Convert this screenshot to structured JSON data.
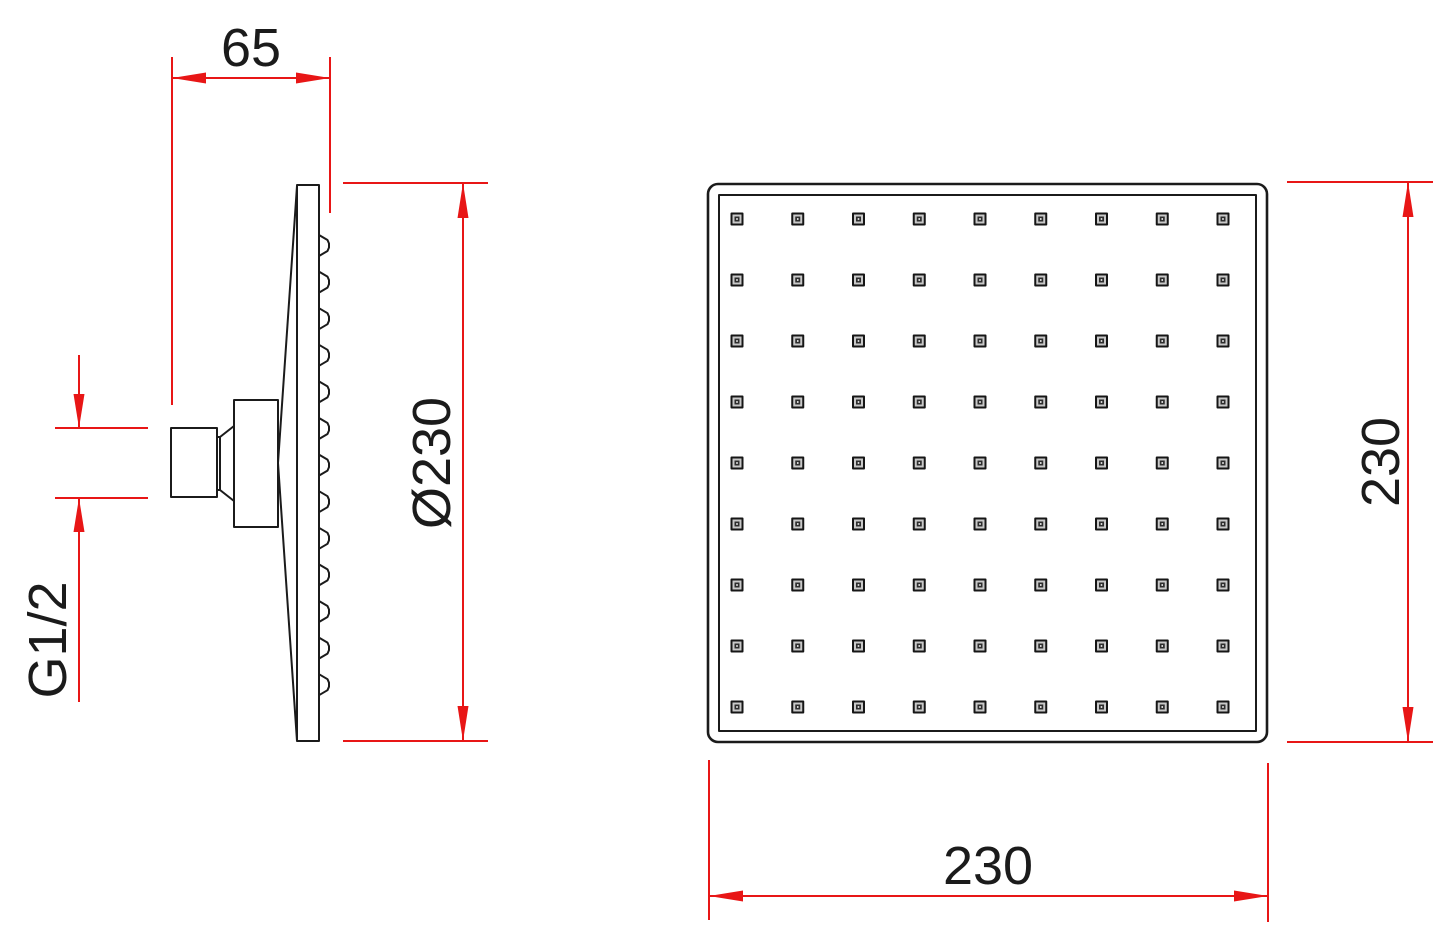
{
  "page": {
    "background": "#ffffff",
    "description": "Technical dimension drawing of a square overhead shower head, side profile view and front face view"
  },
  "colors": {
    "line": "#1b1b1b",
    "dimension": "#e81616"
  },
  "side_view": {
    "name": "shower head side profile",
    "depth_dim": {
      "value": "65"
    },
    "diameter_dim": {
      "value": "Ø230"
    },
    "thread_dim": {
      "value": "G1/2"
    },
    "nozzle_teeth_count": 13
  },
  "front_view": {
    "name": "shower head front face",
    "height_dim": {
      "value": "230"
    },
    "width_dim": {
      "value": "230"
    },
    "nozzle_grid": {
      "rows": 9,
      "cols": 9
    }
  }
}
